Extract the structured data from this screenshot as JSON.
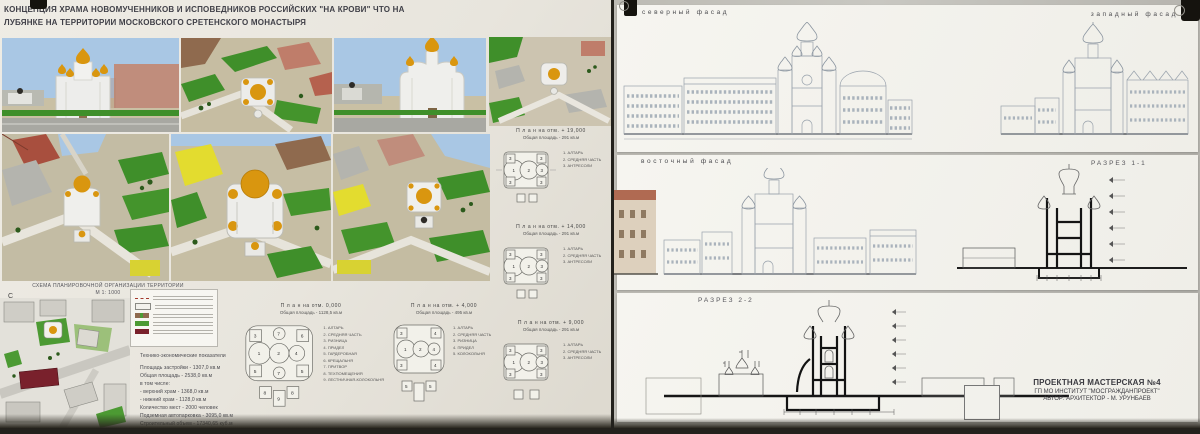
{
  "board_left": {
    "title1": "КОНЦЕПЦИЯ ХРАМА НОВОМУЧЕННИКОВ И ИСПОВЕДНИКОВ РОССИЙСКИХ  \"НА КРОВИ\" ЧТО НА",
    "title2": "ЛУБЯНКЕ НА ТЕРРИТОРИИ МОСКОВСКОГО СРЕТЕНСКОГО   МОНАСТЫРЯ",
    "scheme": {
      "title": "СХЕМА ПЛАНИРОВОЧНОЙ ОРГАНИЗАЦИИ ТЕРРИТОРИИ",
      "scale": "М 1: 1000",
      "north": "С"
    },
    "indicators": {
      "title": "Технико-экономические показатели",
      "rows": [
        "Площадь застройки  - 1307,0 кв.м",
        "Общая площадь        - 2538,0 кв.м",
        "в том числе:",
        "   - верхний храм       - 1368,0 кв.м",
        "   - нижний храм        - 1128,0 кв.м",
        "Количество мест  - 2000 человек",
        "Подземная автопарковка - 3095,0 кв.м",
        "Строительный объем - 17340,65 куб.м"
      ]
    },
    "plans": [
      {
        "title": "П л а н  на отм. + 19,000",
        "area": "Общая площадь - 291 кв.м",
        "legend": [
          "1.  АЛТАРЬ",
          "2.  СРЕДНЯЯ ЧАСТЬ",
          "3.  АНТРЕСОЛИ"
        ]
      },
      {
        "title": "П л а н  на отм. + 14,000",
        "area": "Общая площадь - 291 кв.м",
        "legend": [
          "1.  АЛТАРЬ",
          "2.  СРЕДНЯЯ ЧАСТЬ",
          "3.  АНТРЕСОЛИ"
        ]
      },
      {
        "title": "П л а н  на отм. + 9,000",
        "area": "Общая площадь - 291 кв.м",
        "legend": [
          "1.  АЛТАРЬ",
          "2.  СРЕДНЯЯ ЧАСТЬ",
          "3.  АНТРЕСОЛИ"
        ]
      },
      {
        "title": "П л а н  на отм. 0,000",
        "area": "Общая площадь - 1128,5 кв.м",
        "legend": [
          "1.  АЛТАРЬ",
          "2.  СРЕДНЯЯ ЧАСТЬ",
          "3.  РИЗНИЦА",
          "4.  ПРИДЕЛ",
          "5.  ГАРДЕРОБНАЯ",
          "6.  КРЕЩАЛЬНЯ",
          "7.  ПРИТВОР",
          "8.  ТЕХПОМЕЩЕНИЯ",
          "9.  ЛЕСТНИЧНАЯ-КОЛОКОЛЬНЯ"
        ]
      },
      {
        "title": "П л а н  на отм. + 4,000",
        "area": "Общая площадь - 495 кв.м",
        "legend": [
          "1.  АЛТАРЬ",
          "2.  СРЕДНЯЯ ЧАСТЬ",
          "3.  РИЗНИЦА",
          "4.  ПРИДЕЛ",
          "5.  КОЛОКОЛЬНЯ"
        ]
      }
    ]
  },
  "board_right": {
    "labels": {
      "north": "северный фасад",
      "west": "западный фасад",
      "east": "восточный фасад",
      "section1": "РАЗРЕЗ 1-1",
      "section2": "РАЗРЕЗ 2-2"
    },
    "credits": {
      "l1": "ПРОЕКТНАЯ МАСТЕРСКАЯ №4",
      "l2": "ГП МО ИНСТИТУТ \"МОСГРАЖДАНПРОЕКТ\"",
      "l3": "АВТОР:  АРХИТЕКТОР - М. УРУНБАЕВ"
    }
  },
  "colors": {
    "gold_dome": "#d9960f",
    "sky": "#a9c7e4",
    "grass": "#3f8f2a",
    "board": "#e9e6df",
    "sheet": "#f4f3ee",
    "dark_red_building": "#79212c"
  }
}
